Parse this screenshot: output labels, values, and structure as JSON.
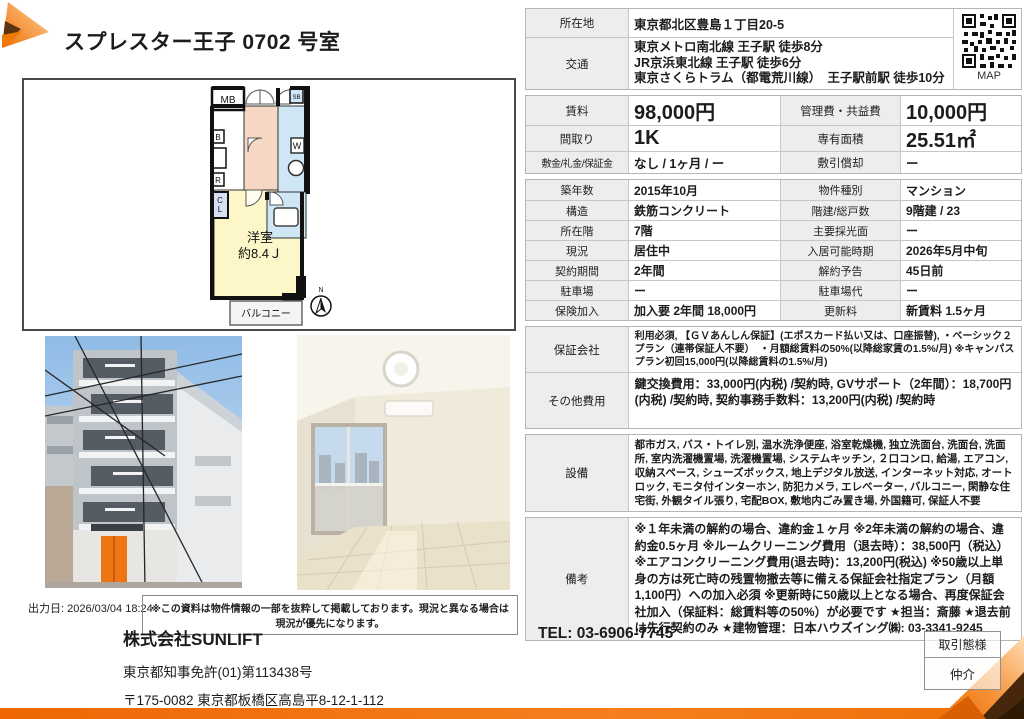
{
  "page": {
    "title": "スプレスター王子 0702 号室",
    "output_date": "出力日: 2026/03/04 18:24",
    "disclaimer": "※この資料は物件情報の一部を抜粋して掲載しております。現況と異なる場合は現況が優先になります。"
  },
  "colors": {
    "accent_orange": "#ee6f05",
    "dark_accent": "#46270b",
    "label_bg": "#ededed",
    "plan_room_yellow": "#fcf6c8",
    "plan_kitchen_pink": "#f6d7c3",
    "plan_bath_blue": "#cfe6f5"
  },
  "floor_plan": {
    "mb": "MB",
    "sb": "SB",
    "b": "B",
    "r": "R",
    "cl": "CL",
    "w": "W",
    "room_name": "洋室",
    "room_size": "約8.4Ｊ",
    "balcony": "バルコニー",
    "north": "N"
  },
  "map": {
    "label": "MAP"
  },
  "table": {
    "address": {
      "label": "所在地",
      "value": "東京都北区豊島１丁目20-5"
    },
    "access": {
      "label": "交通",
      "lines": [
        "東京メトロ南北線 王子駅 徒歩8分",
        "JR京浜東北線 王子駅 徒歩6分",
        "東京さくらトラム（都電荒川線）　王子駅前駅 徒歩10分"
      ]
    },
    "highlight_rows": [
      {
        "label1": "賃料",
        "value1": "98,000円",
        "label2": "管理費・共益費",
        "value2": "10,000円"
      },
      {
        "label1": "間取り",
        "value1": "1K",
        "label2": "専有面積",
        "value2": "25.51㎡"
      },
      {
        "label1": "敷金/礼金/保証金",
        "value1": "なし / 1ヶ月 / ー",
        "label2": "敷引償却",
        "value2": "ー"
      }
    ],
    "detail_rows": [
      {
        "label1": "築年数",
        "value1": "2015年10月",
        "label2": "物件種別",
        "value2": "マンション"
      },
      {
        "label1": "構造",
        "value1": "鉄筋コンクリート",
        "label2": "階建/総戸数",
        "value2": "9階建 / 23"
      },
      {
        "label1": "所在階",
        "value1": "7階",
        "label2": "主要採光面",
        "value2": "ー"
      },
      {
        "label1": "現況",
        "value1": "居住中",
        "label2": "入居可能時期",
        "value2": "2026年5月中旬"
      },
      {
        "label1": "契約期間",
        "value1": "2年間",
        "label2": "解約予告",
        "value2": "45日前"
      },
      {
        "label1": "駐車場",
        "value1": "ー",
        "label2": "駐車場代",
        "value2": "ー"
      },
      {
        "label1": "保険加入",
        "value1": "加入要 2年間 18,000円",
        "label2": "更新料",
        "value2": "新賃料 1.5ヶ月"
      }
    ],
    "guarantor": {
      "label": "保証会社",
      "value": "利用必須, 【ＧＶあんしん保証】(エポスカード払い又は、口座振替), ・ベーシック２プラン（連帯保証人不要）　・月額総賃料の50%(以降総家賃の1.5%/月) ※キャンパスプラン初回15,000円(以降総賃料の1.5%/月)"
    },
    "other_fees": {
      "label": "その他費用",
      "value": "鍵交換費用：33,000円(内税) /契約時, GVサポート（2年間）：18,700円(内税) /契約時, 契約事務手数料：13,200円(内税) /契約時"
    },
    "equipment": {
      "label": "設備",
      "value": "都市ガス, バス・トイレ別, 温水洗浄便座, 浴室乾燥機, 独立洗面台, 洗面台, 洗面所, 室内洗濯機置場, 洗濯機置場, システムキッチン, ２口コンロ, 給湯, エアコン, 収納スペース, シューズボックス, 地上デジタル放送, インターネット対応, オートロック, モニタ付インターホン, 防犯カメラ, エレベーター, バルコニー, 閑静な住宅街, 外観タイル張り, 宅配BOX, 敷地内ごみ置き場, 外国籍可, 保証人不要"
    },
    "notes": {
      "label": "備考",
      "value": "※１年未満の解約の場合、違約金１ヶ月 ※2年未満の解約の場合、違約金0.5ヶ月 ※ルームクリーニング費用（退去時）：38,500円（税込） ※エアコンクリーニング費用(退去時)：13,200円(税込) ※50歳以上単身の方は死亡時の残置物撤去等に備える保証会社指定プラン（月額1,100円）への加入必須 ※更新時に50歳以上となる場合、再度保証会社加入（保証料：総賃料等の50%）が必要です ★担当：斎藤 ★退去前は先行契約のみ ★建物管理：日本ハウズイング㈱: 03-3341-9245"
    }
  },
  "footer": {
    "company": "株式会社SUNLIFT",
    "tel": "TEL: 03-6906-7745",
    "license": "東京都知事免許(01)第113438号",
    "address": "〒175-0082 東京都板橋区高島平8-12-1-112",
    "deal_type_label": "取引態様",
    "deal_type_value": "仲介"
  }
}
